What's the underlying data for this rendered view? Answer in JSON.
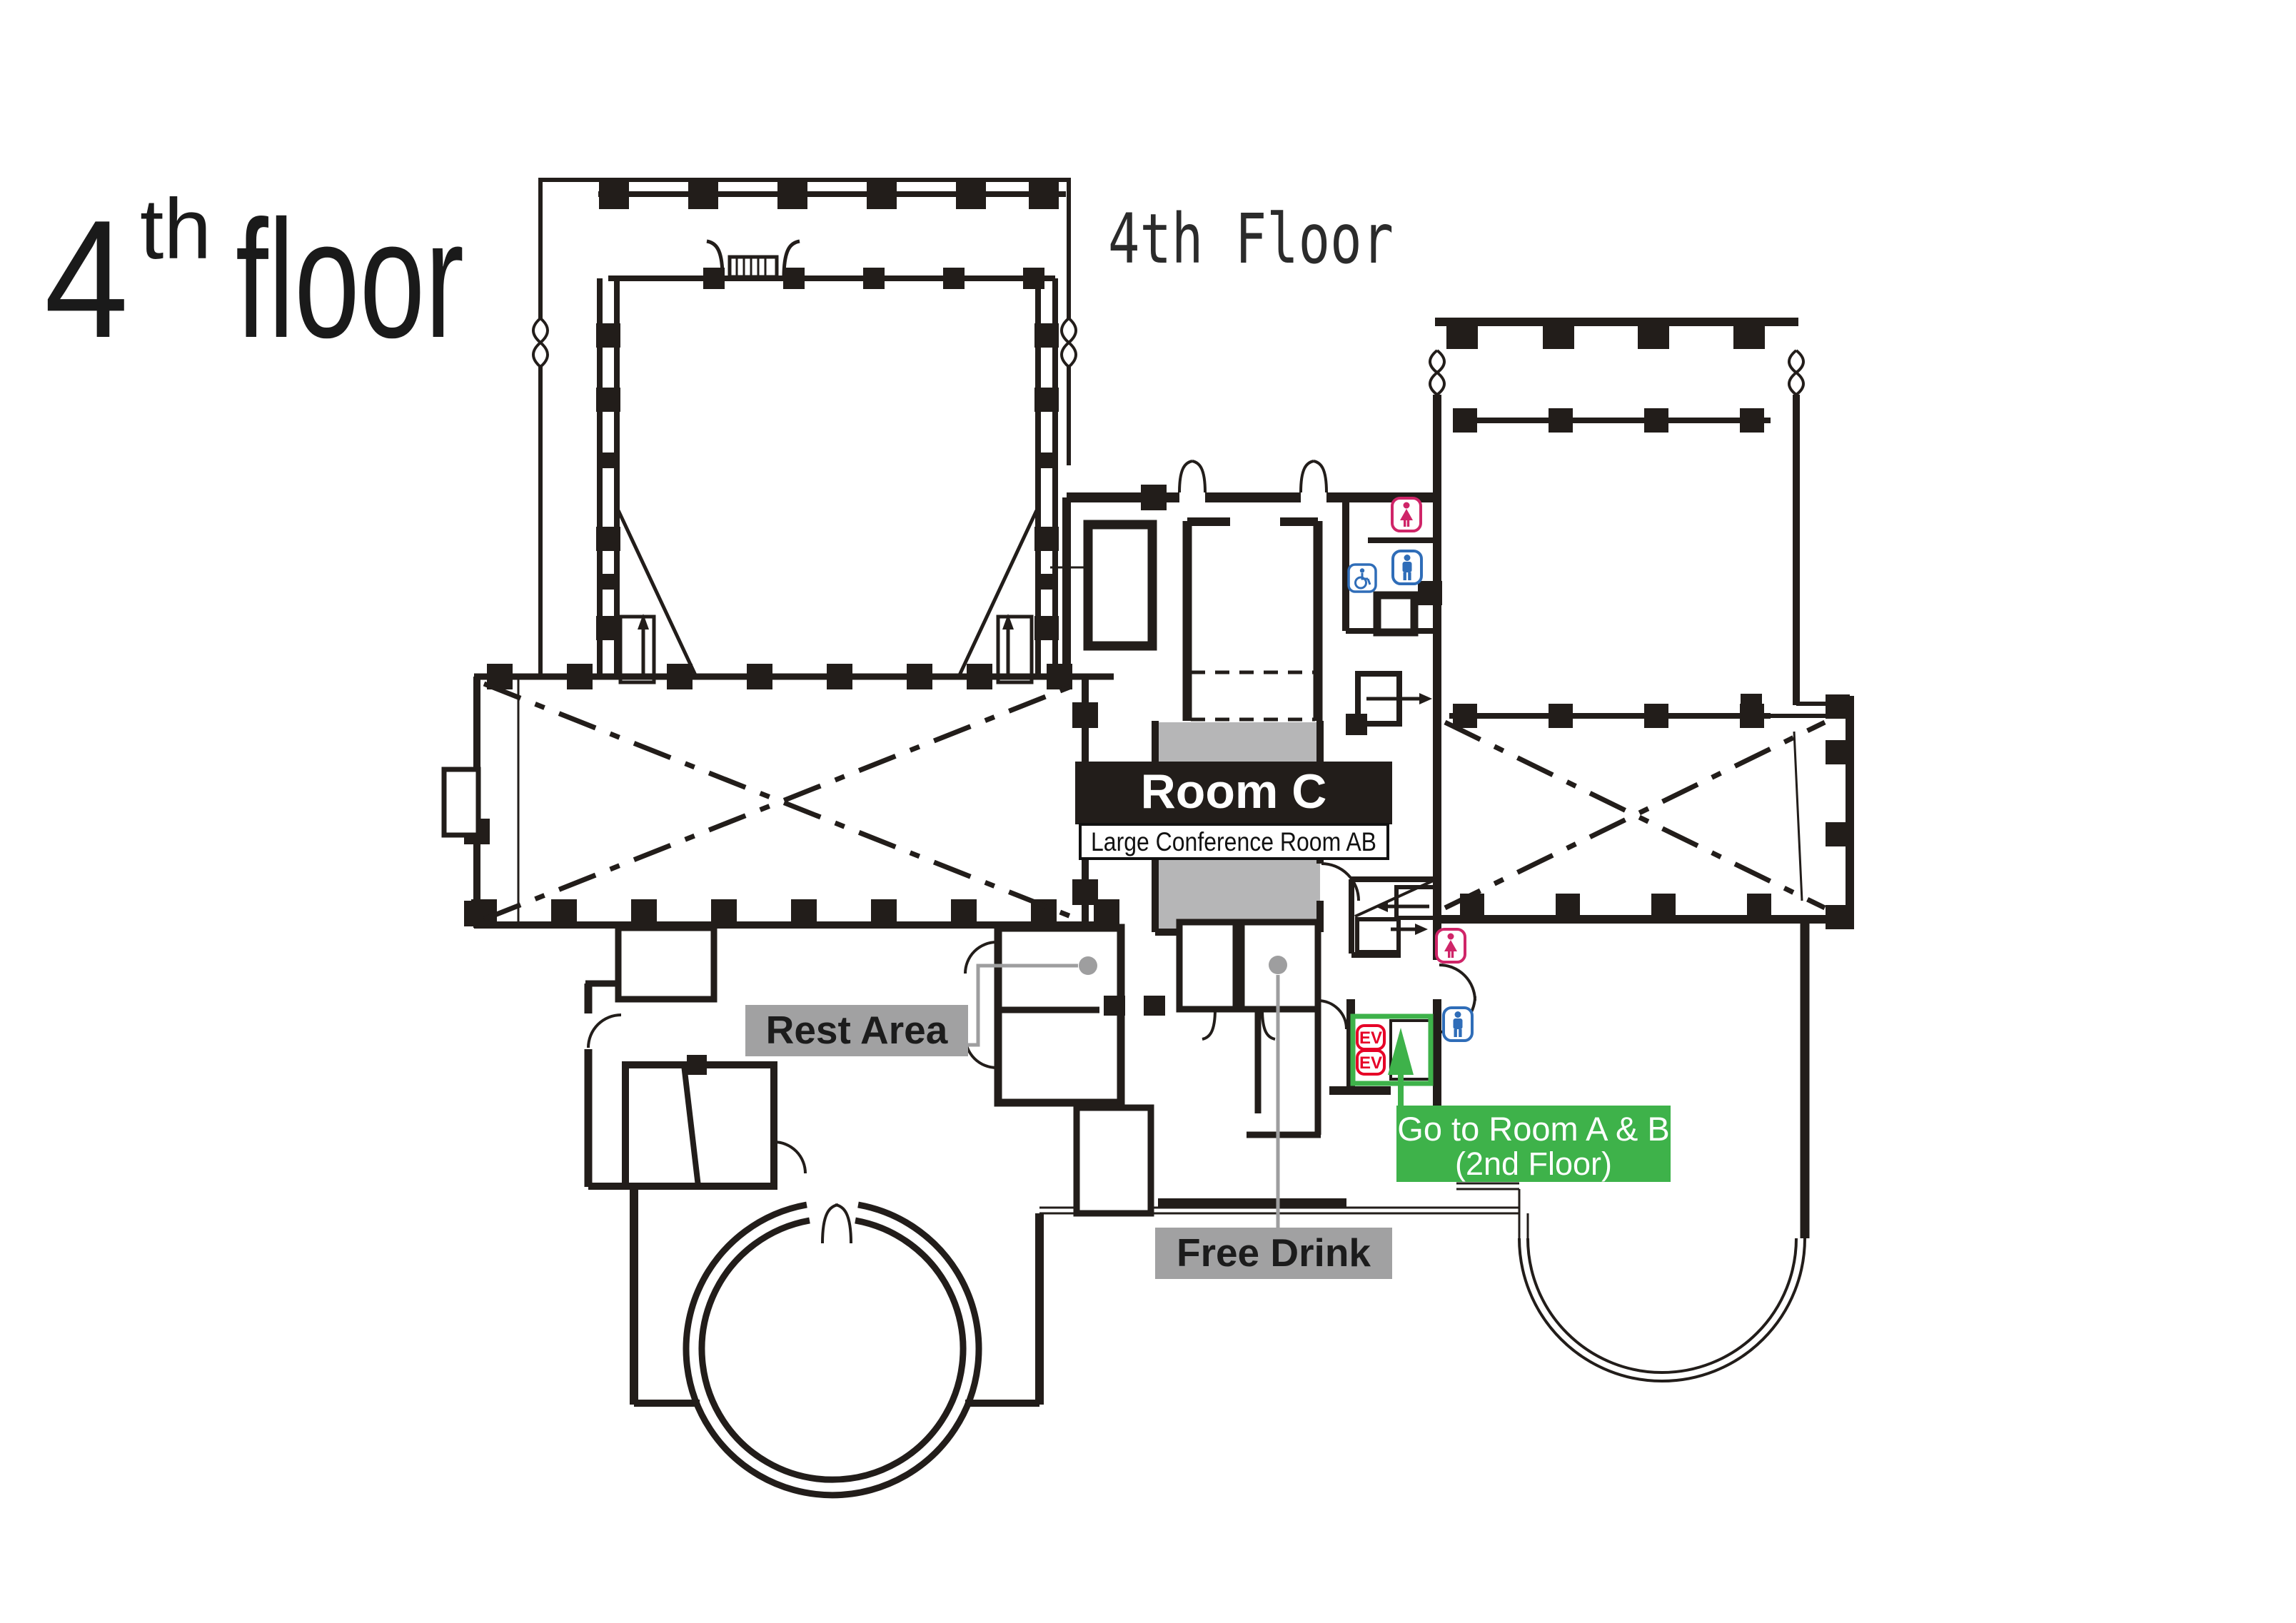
{
  "title": {
    "number": "4",
    "ordinal": "th",
    "word": "floor"
  },
  "heading": "4th Floor",
  "rooms": {
    "room_c": {
      "label": "Room C",
      "subtitle": "Large Conference Room AB"
    },
    "rest_area": "Rest Area",
    "free_drink": "Free Drink"
  },
  "wayfinding": {
    "goto_line1": "Go to Room A & B",
    "goto_line2": "(2nd Floor)",
    "elevator_label": "EV"
  },
  "icons": {
    "womens_restroom": "woman-figure",
    "mens_restroom": "man-figure",
    "accessible_restroom": "wheelchair-figure",
    "elevator": "EV-badge",
    "stairs": "tread-hatch",
    "direction_arrow": "arrow"
  },
  "colors": {
    "wall": "#221d1a",
    "room_fill": "#b6b6b7",
    "label_gray": "#a1a1a2",
    "accent_green": "#3eb24a",
    "accent_red": "#e60027",
    "icon_pink": "#cf2568",
    "icon_blue": "#2f6db8",
    "leader_gray": "#9e9e9f"
  }
}
